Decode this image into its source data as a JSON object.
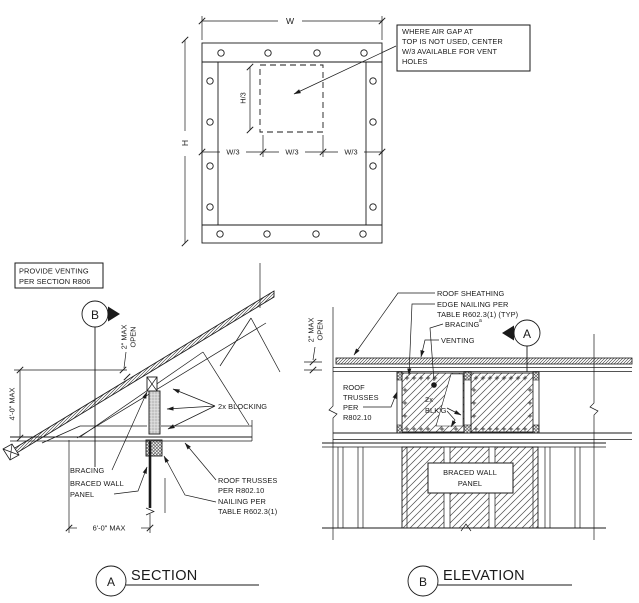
{
  "figure": {
    "plan": {
      "dim_w": "W",
      "dim_h": "H",
      "dim_h3": "H/3",
      "w3": [
        "W/3",
        "W/3",
        "W/3"
      ],
      "callout": [
        "WHERE AIR GAP AT",
        "TOP IS NOT USED, CENTER",
        "W/3 AVAILABLE FOR VENT",
        "HOLES"
      ]
    },
    "section": {
      "note": [
        "PROVIDE VENTING",
        "PER SECTION R806"
      ],
      "cut_marker": "B",
      "dim_2max": [
        "2\" MAX",
        "OPEN"
      ],
      "dim_4ft": "4'-0\" MAX",
      "label_blocking": "2x BLOCKING",
      "label_bracing": "BRACING",
      "label_bwp": [
        "BRACED WALL",
        "PANEL"
      ],
      "label_trusses": [
        "ROOF TRUSSES",
        "PER R802.10"
      ],
      "label_nailing": [
        "NAILING PER",
        "TABLE R602.3(1)"
      ],
      "dim_6ft": "6'-0\" MAX",
      "title_marker": "A",
      "title": "SECTION"
    },
    "elevation": {
      "label_sheathing": "ROOF SHEATHING",
      "label_edge_nailing": [
        "EDGE NAILING PER",
        "TABLE R602.3(1) (TYP)"
      ],
      "label_bracing": "BRACING",
      "bracing_footnote": "a",
      "label_venting": "VENTING",
      "cut_marker": "A",
      "dim_2max": [
        "2\" MAX",
        "OPEN"
      ],
      "label_trusses": [
        "ROOF",
        "TRUSSES",
        "PER",
        "R802.10"
      ],
      "label_blkg": [
        "2x",
        "BLK'G"
      ],
      "label_bwp": [
        "BRACED WALL",
        "PANEL"
      ],
      "title_marker": "B",
      "title": "ELEVATION"
    }
  }
}
